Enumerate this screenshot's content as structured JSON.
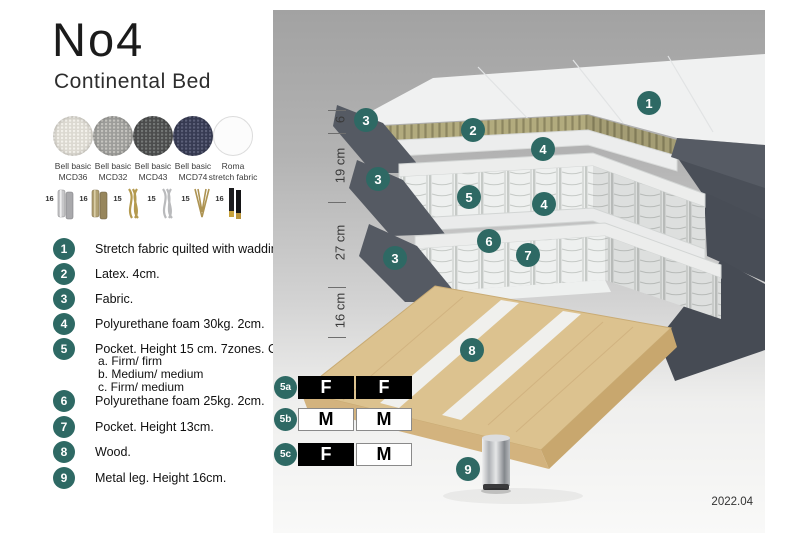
{
  "title": "No4",
  "subtitle": "Continental Bed",
  "swatches": [
    {
      "line1": "Bell basic",
      "line2": "MCD36",
      "base": "#dcd9d1",
      "dot": "#f4f2ec"
    },
    {
      "line1": "Bell basic",
      "line2": "MCD32",
      "base": "#9d9d9a",
      "dot": "#c6c5c0"
    },
    {
      "line1": "Bell basic",
      "line2": "MCD43",
      "base": "#4c4d4d",
      "dot": "#767978"
    },
    {
      "line1": "Bell basic",
      "line2": "MCD74",
      "base": "#373b53",
      "dot": "#5c6079"
    },
    {
      "line1": "Roma",
      "line2": "stretch fabric",
      "base": "#fcfcfc",
      "dot": ""
    }
  ],
  "legs": [
    {
      "height": "16",
      "type": "cylinder-chrome"
    },
    {
      "height": "16",
      "type": "cylinder-brass"
    },
    {
      "height": "15",
      "type": "twisted-gold"
    },
    {
      "height": "15",
      "type": "twisted-silver"
    },
    {
      "height": "15",
      "type": "hairpin-gold"
    },
    {
      "height": "16",
      "type": "cylinder-black-gold"
    }
  ],
  "legend": [
    {
      "num": "1",
      "text": "Stretch fabric quilted with wadding."
    },
    {
      "num": "2",
      "text": "Latex. 4cm."
    },
    {
      "num": "3",
      "text": "Fabric."
    },
    {
      "num": "4",
      "text": "Polyurethane foam 30kg. 2cm."
    },
    {
      "num": "5",
      "text": "Pocket. Height 15 cm. 7zones. Option:"
    },
    {
      "num": "6",
      "text": "Polyurethane foam 25kg. 2cm."
    },
    {
      "num": "7",
      "text": "Pocket. Height 13cm."
    },
    {
      "num": "8",
      "text": "Wood."
    },
    {
      "num": "9",
      "text": "Metal leg. Height 16cm."
    }
  ],
  "pocket_options": [
    "a. Firm/ firm",
    "b. Medium/ medium",
    "c. Firm/ medium"
  ],
  "diagram": {
    "dimensions": [
      "6",
      "19 cm",
      "27 cm",
      "16 cm"
    ],
    "markers": [
      "1",
      "2",
      "3",
      "3",
      "3",
      "4",
      "4",
      "5",
      "6",
      "7",
      "8",
      "9"
    ],
    "firmness": [
      {
        "label": "5a",
        "cells": [
          "F",
          "F"
        ]
      },
      {
        "label": "5b",
        "cells": [
          "M",
          "M"
        ]
      },
      {
        "label": "5c",
        "cells": [
          "F",
          "M"
        ]
      }
    ],
    "version": "2022.04"
  },
  "colors": {
    "accent_teal": "#2e6964",
    "fabric_dark": "#555a63",
    "latex": "#b2ab7e",
    "wood": "#dcc28f",
    "quilt_white": "#f0f1f1"
  }
}
